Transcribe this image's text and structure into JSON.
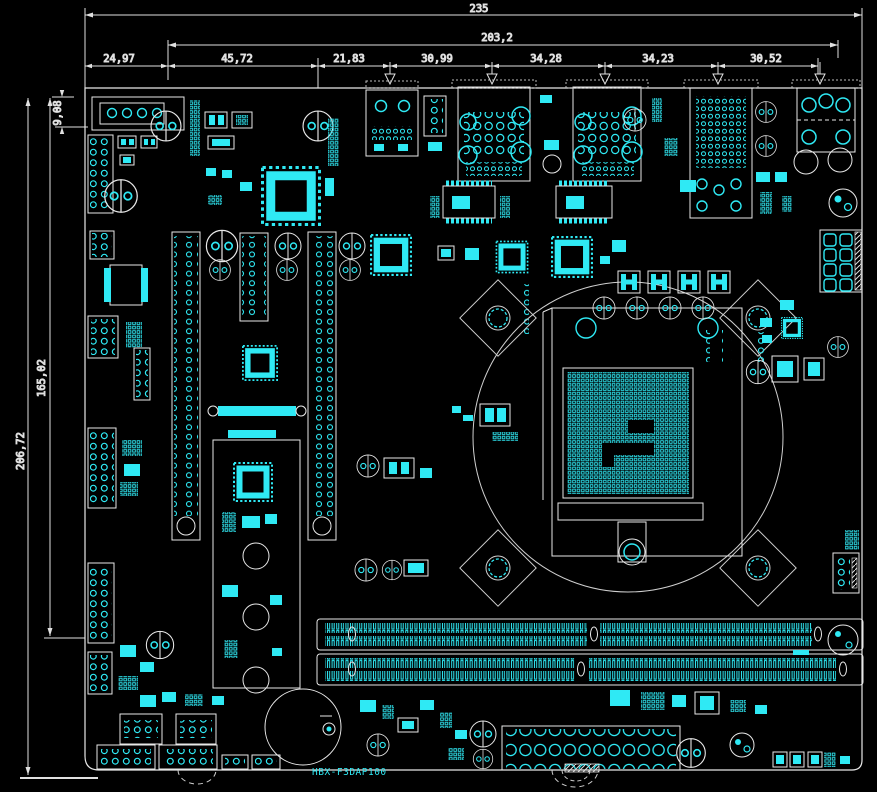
{
  "meta": {
    "drawing_type": "pcb-assembly-cad-drawing",
    "background": "#000000",
    "component_color": "#2fe9f4",
    "outline_color": "#e8e8e8"
  },
  "titleblock": {
    "board_name": "HBX-F3DAP100"
  },
  "dimensions": {
    "horizontal": {
      "total": "235",
      "io_span": "203,2",
      "segments": [
        "24,97",
        "45,72",
        "21,83",
        "30,99",
        "34,28",
        "34,23",
        "30,52"
      ]
    },
    "vertical": {
      "total": "206,72",
      "inner": "165,02",
      "offset_top": "9,08"
    }
  }
}
